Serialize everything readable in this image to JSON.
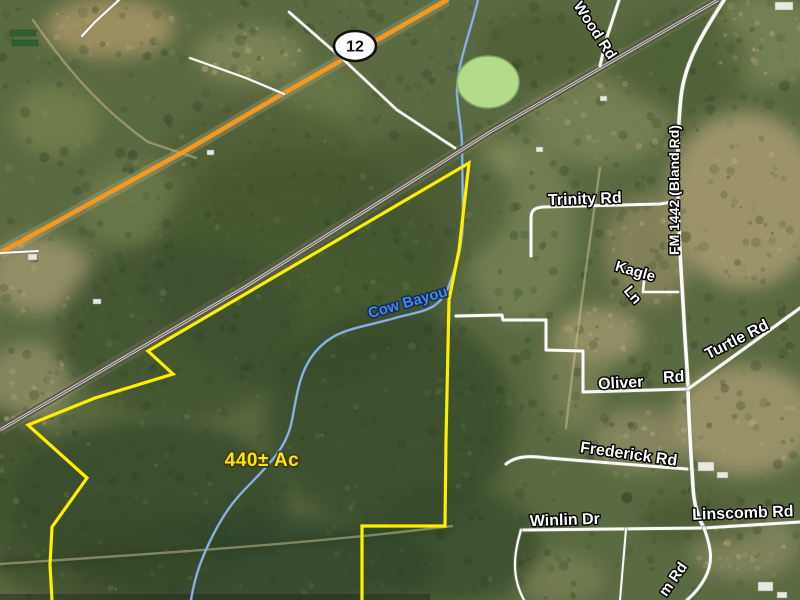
{
  "map": {
    "title": "Aerial property listing map",
    "acreage_label": {
      "text": "440± Ac",
      "x": 262,
      "y": 466,
      "rotate": 0,
      "size": 19,
      "fill": "#ffe400",
      "outline": "#3c3c14"
    },
    "highway": {
      "shield_text": "12",
      "shield": {
        "cx": 355,
        "cy": 46,
        "rx": 21,
        "ry": 15
      },
      "color": "#f5991e",
      "path": "M 447,0 L 279,96 187,150 0,253"
    },
    "railroad": {
      "path": "M 718,0 L 490,132 245,287 0,430",
      "outer": "#54544c",
      "inner": "#cfcabc"
    },
    "boundary": {
      "color": "#ffee00",
      "width": 3.2,
      "points": "52,600 50,565 52,527 87,478 28,425 95,398 173,374 148,351 469,163 459,250 449,300 446,440 445,526 362,526 362,600"
    },
    "water": {
      "creek_color": "#74a2dc",
      "creek_path": "M 478,0 C 468,40 456,68 457,95 C 459,120 462,130 462,145 L 463,215 C 463,245 458,262 448,288 C 438,312 420,311 395,318 C 365,327 340,328 322,345 C 300,365 298,390 292,420 C 287,448 268,465 252,482 C 233,501 225,512 213,535 C 202,557 195,575 191,600",
      "creek_label": {
        "text": "Cow Bayou",
        "x": 409,
        "y": 307,
        "rotate": -16,
        "size": 15,
        "fill": "#4e86d8",
        "outline": "#0d2a5e"
      },
      "pond": {
        "cx": 488,
        "cy": 82,
        "rx": 31,
        "ry": 26,
        "fill": "#b2dc8b",
        "stroke": "#7fa85f"
      }
    },
    "roads": [
      {
        "name": "wood-rd",
        "path": "M 619,0 L 606,40 600,66",
        "w": 3
      },
      {
        "name": "fm-1442",
        "path": "M 724,0 C 705,30 685,60 681,97 C 678,125 677,160 678,200 C 679,245 681,265 684,320 C 686,358 688,375 688,390 C 689,425 691,455 693,487 C 694,505 698,517 704,528",
        "w": 3.6
      },
      {
        "name": "trinity-rd",
        "path": "M 531,256 L 531,219 C 531,210 534,208 543,207 L 660,204 678,201",
        "w": 3
      },
      {
        "name": "kagle-ln",
        "path": "M 644,281 L 643,292 L 678,292",
        "w": 2.6
      },
      {
        "name": "oliver-rd",
        "path": "M 456,316 L 502,315 L 503,320 L 546,320 L 546,350 L 583,351 L 583,392 L 688,389",
        "w": 3
      },
      {
        "name": "turtle-rd",
        "path": "M 688,389 L 741,351 800,308",
        "w": 3.2
      },
      {
        "name": "frederick-rd",
        "path": "M 506,464 C 517,455 532,456 548,458 L 687,469",
        "w": 3
      },
      {
        "name": "winlin-dr",
        "path": "M 521,530 L 704,528",
        "w": 3
      },
      {
        "name": "linscomb-rd",
        "path": "M 704,528 L 800,522",
        "w": 3
      },
      {
        "name": "m-rd",
        "path": "M 704,528 C 712,550 713,563 705,578 C 699,589 693,595 687,600",
        "w": 3
      },
      {
        "name": "winlin-south-rd",
        "path": "M 521,530 C 513,556 512,578 524,600",
        "w": 2.2
      },
      {
        "name": "south-lane",
        "path": "M 626,529 L 620,600",
        "w": 2
      },
      {
        "name": "rail-crossing-rd",
        "path": "M 289,12 L 345,61 397,110 455,148",
        "w": 2.6
      },
      {
        "name": "nw-corner-rd",
        "path": "M 119,0 L 95,22 82,36",
        "w": 2.2
      },
      {
        "name": "nw-frontage-rd",
        "path": "M 190,58 L 246,78 284,94",
        "w": 2.2
      },
      {
        "name": "left-driveway",
        "path": "M 0,253 L 38,251",
        "w": 2
      }
    ],
    "dirt_paths": [
      {
        "name": "farm-track-nw",
        "path": "M 33,20 C 62,62 96,105 148,142 L 196,158"
      },
      {
        "name": "property-track",
        "path": "M 0,564 C 120,556 300,545 452,526"
      },
      {
        "name": "field-trail",
        "path": "M 600,168 C 590,240 577,330 566,428"
      }
    ],
    "road_labels": [
      {
        "name": "wood-rd-label",
        "text": "Wood Rd",
        "x": 591,
        "y": 33,
        "rotate": 57,
        "size": 15
      },
      {
        "name": "trinity-rd-label",
        "text": "Trinity Rd",
        "x": 585,
        "y": 204,
        "rotate": -2,
        "size": 16
      },
      {
        "name": "fm-1442-label",
        "text": "FM 1442 (Bland Rd)",
        "x": 679,
        "y": 190,
        "rotate": -90,
        "size": 14
      },
      {
        "name": "kagle-label",
        "text": "Kagle",
        "x": 634,
        "y": 276,
        "rotate": 16,
        "size": 15
      },
      {
        "name": "kagle-ln-label",
        "text": "Ln",
        "x": 629,
        "y": 298,
        "rotate": 50,
        "size": 15
      },
      {
        "name": "turtle-rd-label",
        "text": "Turtle Rd",
        "x": 739,
        "y": 344,
        "rotate": -27,
        "size": 16
      },
      {
        "name": "oliver-label",
        "text": "Oliver",
        "x": 621,
        "y": 388,
        "rotate": -3,
        "size": 16
      },
      {
        "name": "oliver-rd-label",
        "text": "Rd",
        "x": 674,
        "y": 382,
        "rotate": -3,
        "size": 16
      },
      {
        "name": "frederick-rd-label",
        "text": "Frederick Rd",
        "x": 628,
        "y": 459,
        "rotate": 8,
        "size": 16
      },
      {
        "name": "winlin-dr-label",
        "text": "Winlin Dr",
        "x": 565,
        "y": 525,
        "rotate": -2,
        "size": 16
      },
      {
        "name": "linscomb-rd-label",
        "text": "Linscomb Rd",
        "x": 743,
        "y": 518,
        "rotate": -2,
        "size": 16
      },
      {
        "name": "m-rd-label",
        "text": "m Rd",
        "x": 677,
        "y": 582,
        "rotate": -55,
        "size": 15
      }
    ],
    "buildings": [
      [
        698,
        462,
        16,
        9
      ],
      [
        717,
        472,
        11,
        6
      ],
      [
        758,
        582,
        15,
        9
      ],
      [
        777,
        592,
        10,
        6
      ],
      [
        775,
        2,
        18,
        8
      ],
      [
        341,
        54,
        8,
        5
      ],
      [
        207,
        150,
        7,
        5
      ],
      [
        28,
        254,
        9,
        6
      ],
      [
        93,
        299,
        8,
        5
      ],
      [
        536,
        147,
        7,
        5
      ],
      [
        600,
        96,
        7,
        5
      ]
    ],
    "greenhouses": [
      [
        10,
        30,
        26,
        6
      ],
      [
        12,
        40,
        26,
        6
      ]
    ],
    "terrain": {
      "base": "#5a6a41",
      "patches": [
        [
          110,
          28,
          65,
          30,
          "#a39364",
          0.9,
          1
        ],
        [
          250,
          55,
          55,
          28,
          "#8f9260",
          0.6,
          1
        ],
        [
          765,
          40,
          55,
          45,
          "#8b9364",
          0.55,
          1
        ],
        [
          55,
          120,
          45,
          35,
          "#859055",
          0.5,
          0
        ],
        [
          150,
          205,
          70,
          45,
          "#75854f",
          0.5,
          0
        ],
        [
          40,
          275,
          52,
          38,
          "#a09770",
          0.8,
          1
        ],
        [
          28,
          385,
          42,
          42,
          "#97926a",
          0.7,
          1
        ],
        [
          520,
          230,
          55,
          95,
          "#83905e",
          0.55,
          0
        ],
        [
          600,
          120,
          70,
          45,
          "#8b9162",
          0.55,
          1
        ],
        [
          745,
          200,
          78,
          88,
          "#a89b72",
          0.85,
          1
        ],
        [
          650,
          250,
          45,
          55,
          "#9c9067",
          0.6,
          1
        ],
        [
          600,
          335,
          42,
          28,
          "#ac9f76",
          0.7,
          1
        ],
        [
          745,
          420,
          72,
          55,
          "#a89b72",
          0.8,
          1
        ],
        [
          640,
          440,
          50,
          32,
          "#9f9470",
          0.6,
          1
        ],
        [
          575,
          372,
          30,
          60,
          "#8f8f62",
          0.5,
          0
        ],
        [
          745,
          545,
          55,
          35,
          "#95926b",
          0.6,
          1
        ],
        [
          560,
          578,
          45,
          25,
          "#8a8d5f",
          0.5,
          0
        ],
        [
          490,
          162,
          25,
          18,
          "#98a06a",
          0.5,
          0
        ],
        [
          320,
          95,
          45,
          30,
          "#6f8048",
          0.5,
          0
        ],
        [
          300,
          270,
          150,
          120,
          "#42542f",
          0.8,
          0
        ],
        [
          180,
          330,
          120,
          90,
          "#3e502d",
          0.7,
          0
        ],
        [
          390,
          420,
          125,
          110,
          "#394b2a",
          0.8,
          0
        ],
        [
          150,
          500,
          140,
          80,
          "#364829",
          0.8,
          0
        ],
        [
          260,
          565,
          180,
          50,
          "#32452a",
          0.8,
          0
        ],
        [
          450,
          545,
          90,
          60,
          "#364829",
          0.7,
          0
        ],
        [
          420,
          200,
          90,
          70,
          "#445731",
          0.6,
          0
        ],
        [
          260,
          160,
          100,
          60,
          "#48592f",
          0.5,
          0
        ],
        [
          680,
          60,
          70,
          50,
          "#4a5c33",
          0.6,
          0
        ],
        [
          540,
          50,
          60,
          40,
          "#47582f",
          0.5,
          0
        ],
        [
          0,
          480,
          60,
          70,
          "#3b4d2c",
          0.7,
          0
        ],
        [
          700,
          520,
          60,
          22,
          "#43542f",
          0.6,
          0
        ],
        [
          105,
          560,
          110,
          45,
          "#3a4c2b",
          0.7,
          0
        ]
      ]
    },
    "speckle": {
      "seed": 7,
      "dark": {
        "count": 760,
        "rmin": 1.5,
        "rmax": 5.5,
        "omin": 0.16,
        "omax": 0.34,
        "colors": [
          "#2d4024",
          "#354a28",
          "#3c5230",
          "#2a3b22"
        ]
      },
      "light": {
        "count": 420,
        "rmin": 1.0,
        "rmax": 4.0,
        "omin": 0.12,
        "omax": 0.28,
        "colors": [
          "#6d7f4a",
          "#7d8c54",
          "#5d7040",
          "#8c9a60"
        ]
      },
      "tan": {
        "count": 270,
        "rmin": 1.0,
        "rmax": 3.5,
        "omin": 0.22,
        "omax": 0.45,
        "colors": [
          "#b3a478",
          "#c0b086",
          "#9b8f66"
        ]
      }
    },
    "label_style": {
      "fill": "#ffffff",
      "outline": "#000000"
    }
  }
}
